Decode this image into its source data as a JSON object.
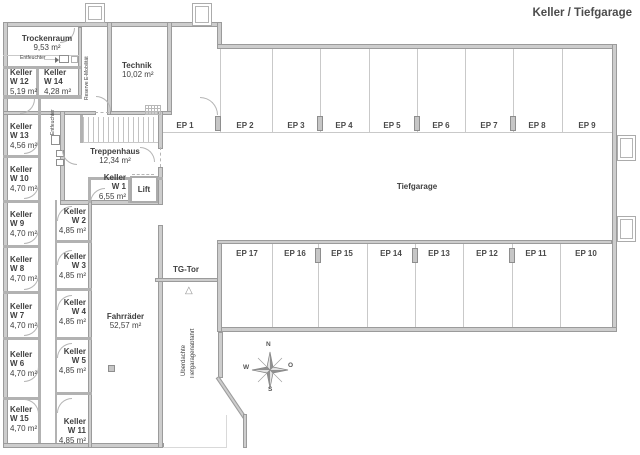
{
  "title": "Keller / Tiefgarage",
  "rooms": {
    "trockenraum": {
      "name": "Trockenraum",
      "area": "9,53 m²"
    },
    "technik": {
      "name": "Technik",
      "area": "10,02 m²"
    },
    "treppenhaus": {
      "name": "Treppenhaus",
      "area": "12,34 m²"
    },
    "lift": {
      "name": "Lift"
    },
    "fahrraeder": {
      "name": "Fahrräder",
      "area": "52,57 m²"
    },
    "tiefgarage": {
      "name": "Tiefgarage"
    },
    "w1": {
      "name": "Keller",
      "num": "W 1",
      "area": "6,55 m²"
    },
    "w2": {
      "name": "Keller",
      "num": "W 2",
      "area": "4,85 m²"
    },
    "w3": {
      "name": "Keller",
      "num": "W 3",
      "area": "4,85 m²"
    },
    "w4": {
      "name": "Keller",
      "num": "W 4",
      "area": "4,85 m²"
    },
    "w5": {
      "name": "Keller",
      "num": "W 5",
      "area": "4,85 m²"
    },
    "w6": {
      "name": "Keller",
      "num": "W 6",
      "area": "4,70 m²"
    },
    "w7": {
      "name": "Keller",
      "num": "W 7",
      "area": "4,70 m²"
    },
    "w8": {
      "name": "Keller",
      "num": "W 8",
      "area": "4,70 m²"
    },
    "w9": {
      "name": "Keller",
      "num": "W 9",
      "area": "4,70 m²"
    },
    "w10": {
      "name": "Keller",
      "num": "W 10",
      "area": "4,70 m²"
    },
    "w11": {
      "name": "Keller",
      "num": "W 11",
      "area": "4,85 m²"
    },
    "w12": {
      "name": "Keller",
      "num": "W 12",
      "area": "5,19 m²"
    },
    "w13": {
      "name": "Keller",
      "num": "W 13",
      "area": "4,56 m²"
    },
    "w14": {
      "name": "Keller",
      "num": "W 14",
      "area": "4,28 m²"
    },
    "w15": {
      "name": "Keller",
      "num": "W 15",
      "area": "4,70 m²"
    }
  },
  "labels": {
    "tg_tor": "TG-Tor",
    "ramp_line1": "Überdachte",
    "ramp_line2": "Tiefgaragenabfahrt",
    "ramp_arrow": "△",
    "reserve": "Reserve E-Mobilität",
    "entfeuchter": "Entfeuchter",
    "entfeuchter2": "Entfeuchter"
  },
  "parking": {
    "top_row": [
      "EP 1",
      "EP 2",
      "EP 3",
      "EP 4",
      "EP 5",
      "EP 6",
      "EP 7",
      "EP 8",
      "EP 9"
    ],
    "bottom_row": [
      "EP 17",
      "EP 16",
      "EP 15",
      "EP 14",
      "EP 13",
      "EP 12",
      "EP 11",
      "EP 10"
    ]
  },
  "compass": {
    "n": "N",
    "o": "O",
    "s": "S",
    "w": "W"
  },
  "colors": {
    "wall_fill": "#cdcdcd",
    "wall_edge": "#9b9b9b",
    "text": "#3f3f3f"
  }
}
